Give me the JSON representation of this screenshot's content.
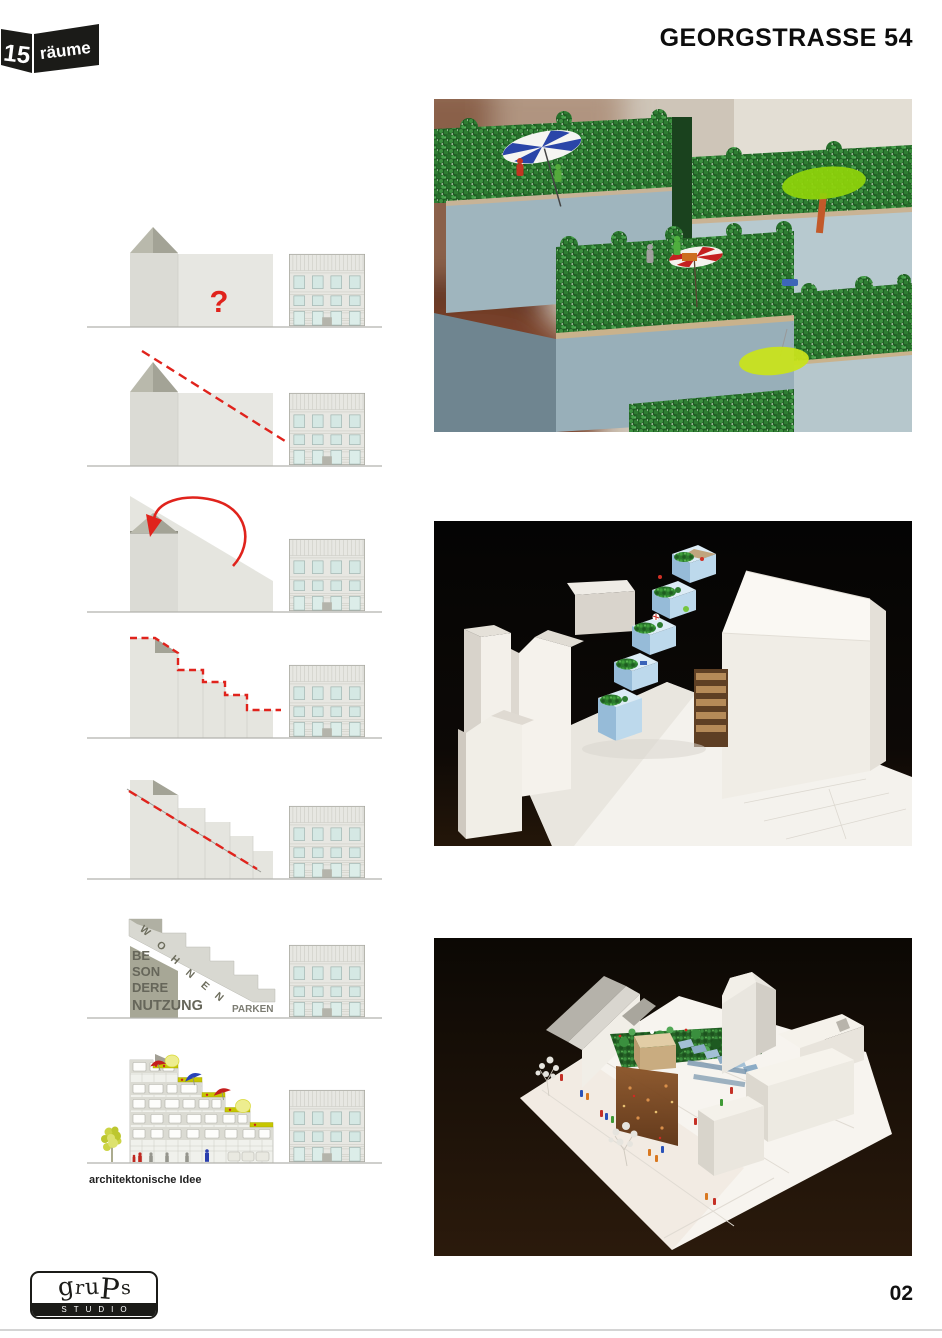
{
  "header": {
    "brand_number": "15",
    "brand_word": "räume",
    "title": "GEORGSTRASSE 54"
  },
  "concept": {
    "question_mark": "?",
    "wohnen_letters": [
      "W",
      "O",
      "H",
      "N",
      "E",
      "N"
    ],
    "besondere_lines": [
      "BE",
      "SON",
      "DERE",
      "NUTZUNG"
    ],
    "parken_label": "PARKEN",
    "caption": "architektonische Idee"
  },
  "footer": {
    "logo_letters": [
      "g",
      "r",
      "u",
      "P",
      "s"
    ],
    "logo_subtitle": "STUDIO",
    "page_number": "02"
  },
  "colors": {
    "accent_red": "#e0231c",
    "massing_light": "#e6e6e1",
    "massing_mid": "#dadad4",
    "roof_dark": "#a3a396",
    "olive_block": "#a7a796",
    "text_olive": "#66665a",
    "terrace_yellow": "#c6c600",
    "window_blue": "#d5e8e4",
    "logo_black": "#1b1b18",
    "ground_line": "#b2b2ad"
  }
}
